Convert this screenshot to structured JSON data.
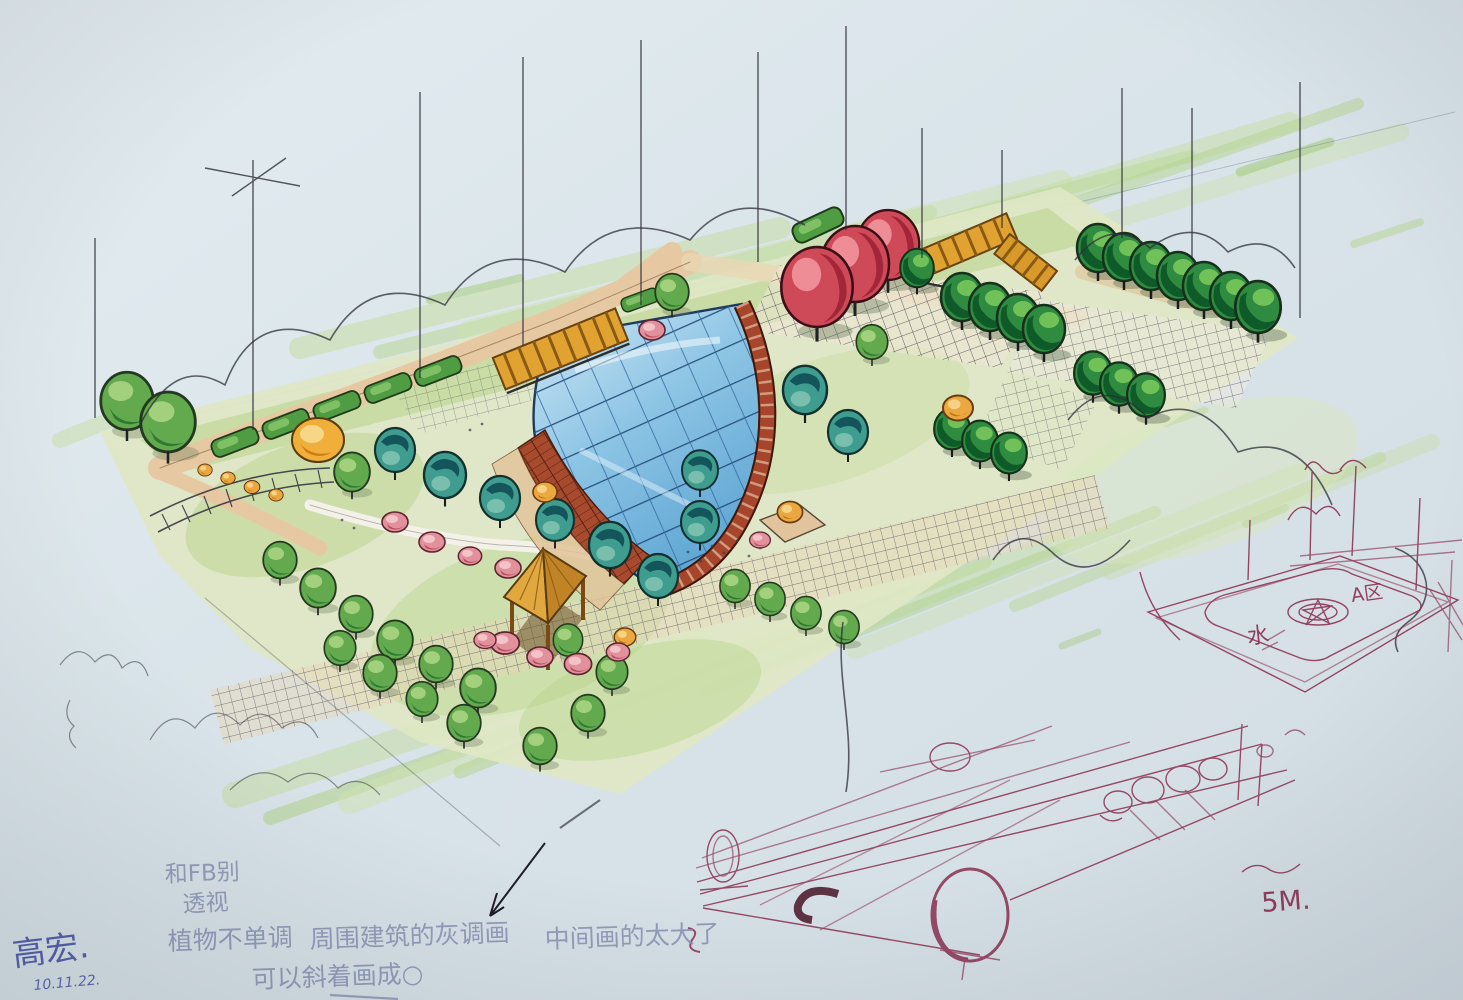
{
  "artwork": {
    "kind": "hand-drawn landscape park plan, marker and pen sketch"
  },
  "annotations": {
    "critique_line1": "和FB别",
    "critique_line2": "透视",
    "critique_line3a": "植物不单调",
    "critique_line3b": "周围建筑的灰调画",
    "critique_line3c": "中间画的太大了",
    "critique_line4": "可以斜着画成○",
    "signature": "高宏.",
    "date": "10.11.22.",
    "scale_note": "5M.",
    "detail_water_label": "水",
    "detail_area_label": "A区"
  },
  "palette": {
    "paper": "#dbe5ea",
    "marker_light_green": "#bcd795",
    "marker_green": "#6fae55",
    "marker_dark_green": "#1e6b33",
    "marker_teal": "#3f9d90",
    "marker_dark_teal": "#14555c",
    "marker_red_tree": "#cf4a58",
    "marker_brick": "#a84a2e",
    "marker_tan_path": "#e6c9a2",
    "marker_wood": "#dfa23c",
    "pool_blue": "#7fbfe2",
    "pen_black": "#2e2e38",
    "pen_maroon": "#8a3050",
    "pen_blue_signature": "#3f4a9e",
    "pencil_gray": "#8892b2"
  }
}
